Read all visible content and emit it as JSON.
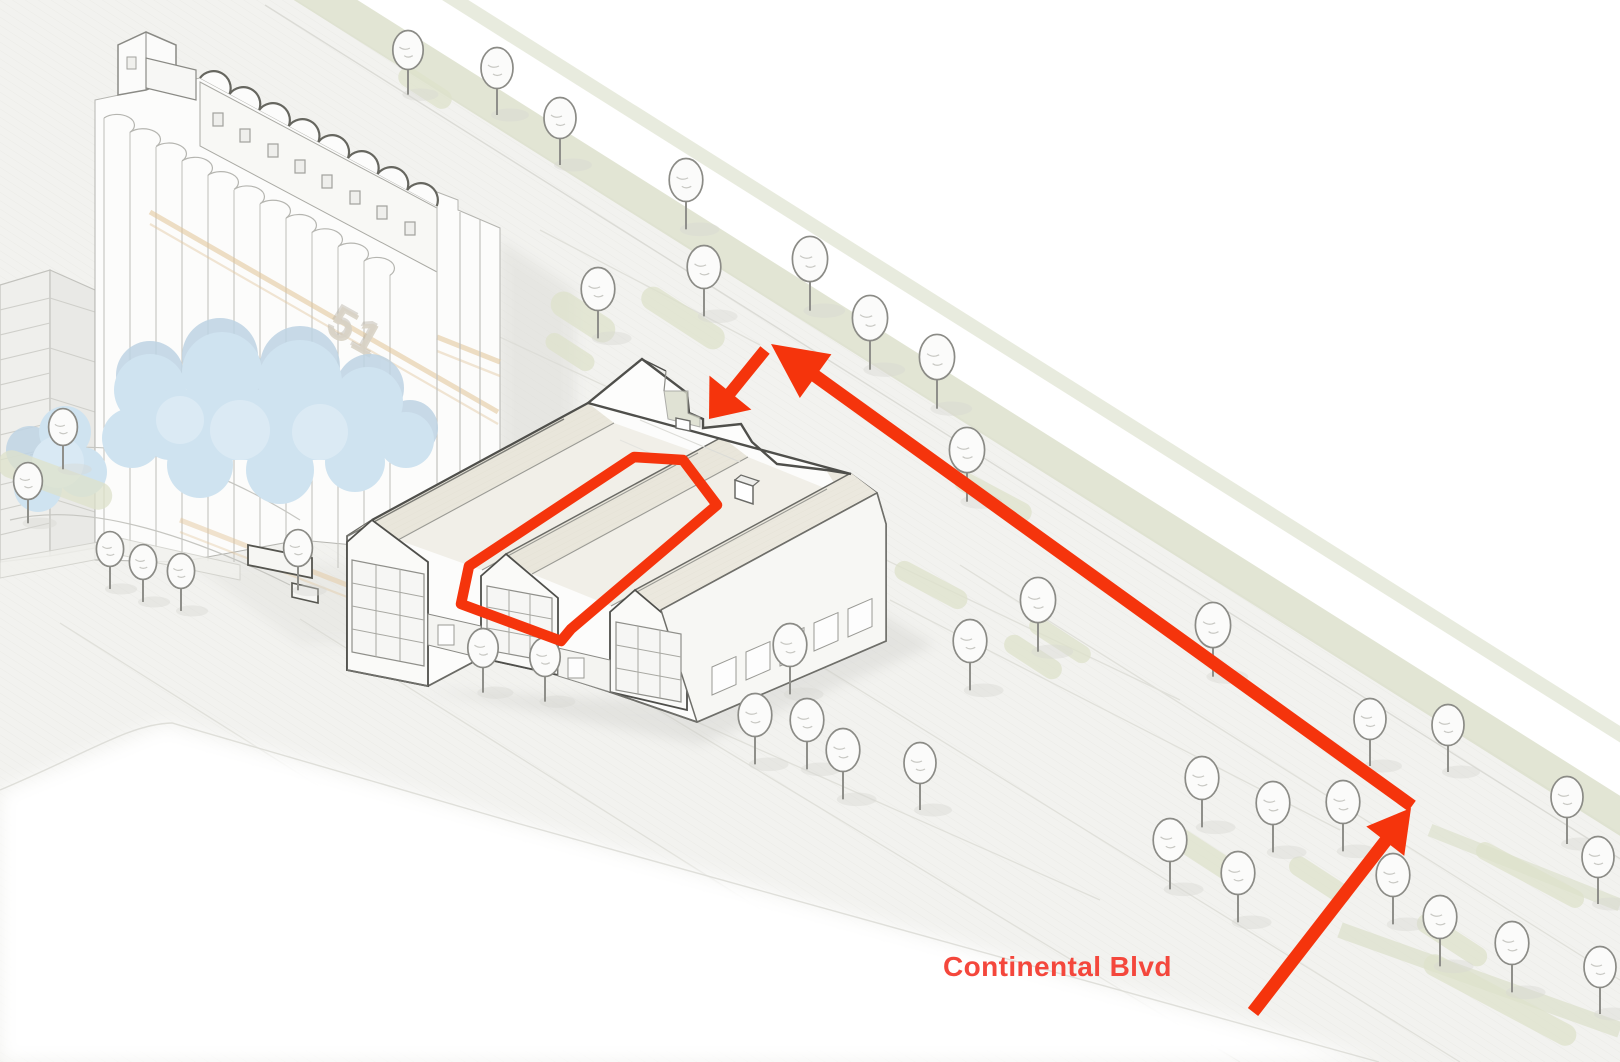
{
  "labels": {
    "street": "Continental Blvd",
    "silo_number": "51"
  },
  "colors": {
    "route_red": "#f5340c",
    "label_red": "#f4473c",
    "ground": "#f2f2ef",
    "planting": "#dde1cb",
    "roof_cream": "#eeebe1",
    "outline_dark": "#4f4f4b",
    "water_blue": "#cfe3f0",
    "water_blue_dark": "#b9d0e1",
    "tan_band": "#e3c89f",
    "tree_stroke": "#8b8b86",
    "tree_fill": "#fbfbfa"
  },
  "route": {
    "description": "access route from Continental Blvd to unit entry",
    "unit_outline_points": "634,457 683,460 717,505 571,629 561,641 461,604 469,566",
    "outline_stroke_width": 10.5,
    "arrows": [
      {
        "name": "approach-arrow",
        "from": [
          1253,
          1012
        ],
        "to": [
          1411,
          808
        ],
        "width": 13,
        "head_len": 42,
        "head_halfw": 24
      },
      {
        "name": "street-arrow",
        "from": [
          1412,
          806
        ],
        "to": [
          771,
          344
        ],
        "width": 13,
        "head_len": 55,
        "head_halfw": 27
      },
      {
        "name": "entry-arrow",
        "from": [
          765,
          350
        ],
        "to": [
          709,
          419
        ],
        "width": 12,
        "head_len": 34,
        "head_halfw": 27
      }
    ]
  },
  "vegetation": {
    "trees": [
      [
        408,
        50,
        0.95
      ],
      [
        497,
        68,
        1
      ],
      [
        560,
        118,
        1
      ],
      [
        686,
        180,
        1.05
      ],
      [
        598,
        289,
        1.05
      ],
      [
        704,
        267,
        1.05
      ],
      [
        810,
        259,
        1.1
      ],
      [
        870,
        318,
        1.1
      ],
      [
        937,
        357,
        1.1
      ],
      [
        967,
        450,
        1.1
      ],
      [
        1038,
        600,
        1.1
      ],
      [
        1213,
        625,
        1.1
      ],
      [
        1370,
        719,
        1
      ],
      [
        1448,
        725,
        1
      ],
      [
        1567,
        797,
        1
      ],
      [
        1598,
        857,
        1
      ],
      [
        63,
        427,
        0.9
      ],
      [
        28,
        481,
        0.9
      ],
      [
        110,
        549,
        0.85
      ],
      [
        143,
        562,
        0.85
      ],
      [
        181,
        571,
        0.85
      ],
      [
        298,
        548,
        0.9
      ],
      [
        483,
        648,
        0.95
      ],
      [
        545,
        657,
        0.95
      ],
      [
        790,
        645,
        1.05
      ],
      [
        755,
        715,
        1.05
      ],
      [
        807,
        720,
        1.05
      ],
      [
        843,
        750,
        1.05
      ],
      [
        920,
        763,
        1
      ],
      [
        970,
        641,
        1.05
      ],
      [
        1202,
        778,
        1.05
      ],
      [
        1273,
        803,
        1.05
      ],
      [
        1343,
        802,
        1.05
      ],
      [
        1170,
        840,
        1.05
      ],
      [
        1238,
        873,
        1.05
      ],
      [
        1393,
        875,
        1.05
      ],
      [
        1440,
        917,
        1.05
      ],
      [
        1512,
        943,
        1.05
      ],
      [
        1600,
        967,
        1
      ]
    ],
    "pads": [
      [
        425,
        88,
        60,
        20,
        33
      ],
      [
        583,
        317,
        72,
        26,
        33
      ],
      [
        683,
        318,
        95,
        24,
        33
      ],
      [
        570,
        352,
        55,
        18,
        33
      ],
      [
        993,
        497,
        85,
        20,
        28
      ],
      [
        931,
        585,
        80,
        20,
        28
      ],
      [
        1033,
        657,
        65,
        20,
        33
      ],
      [
        1060,
        640,
        70,
        18,
        33
      ],
      [
        1205,
        855,
        90,
        22,
        33
      ],
      [
        1320,
        880,
        70,
        20,
        33
      ],
      [
        1452,
        940,
        80,
        20,
        33
      ],
      [
        55,
        480,
        120,
        28,
        20
      ],
      [
        1500,
        1000,
        170,
        22,
        28
      ],
      [
        1530,
        875,
        120,
        18,
        28
      ]
    ]
  }
}
